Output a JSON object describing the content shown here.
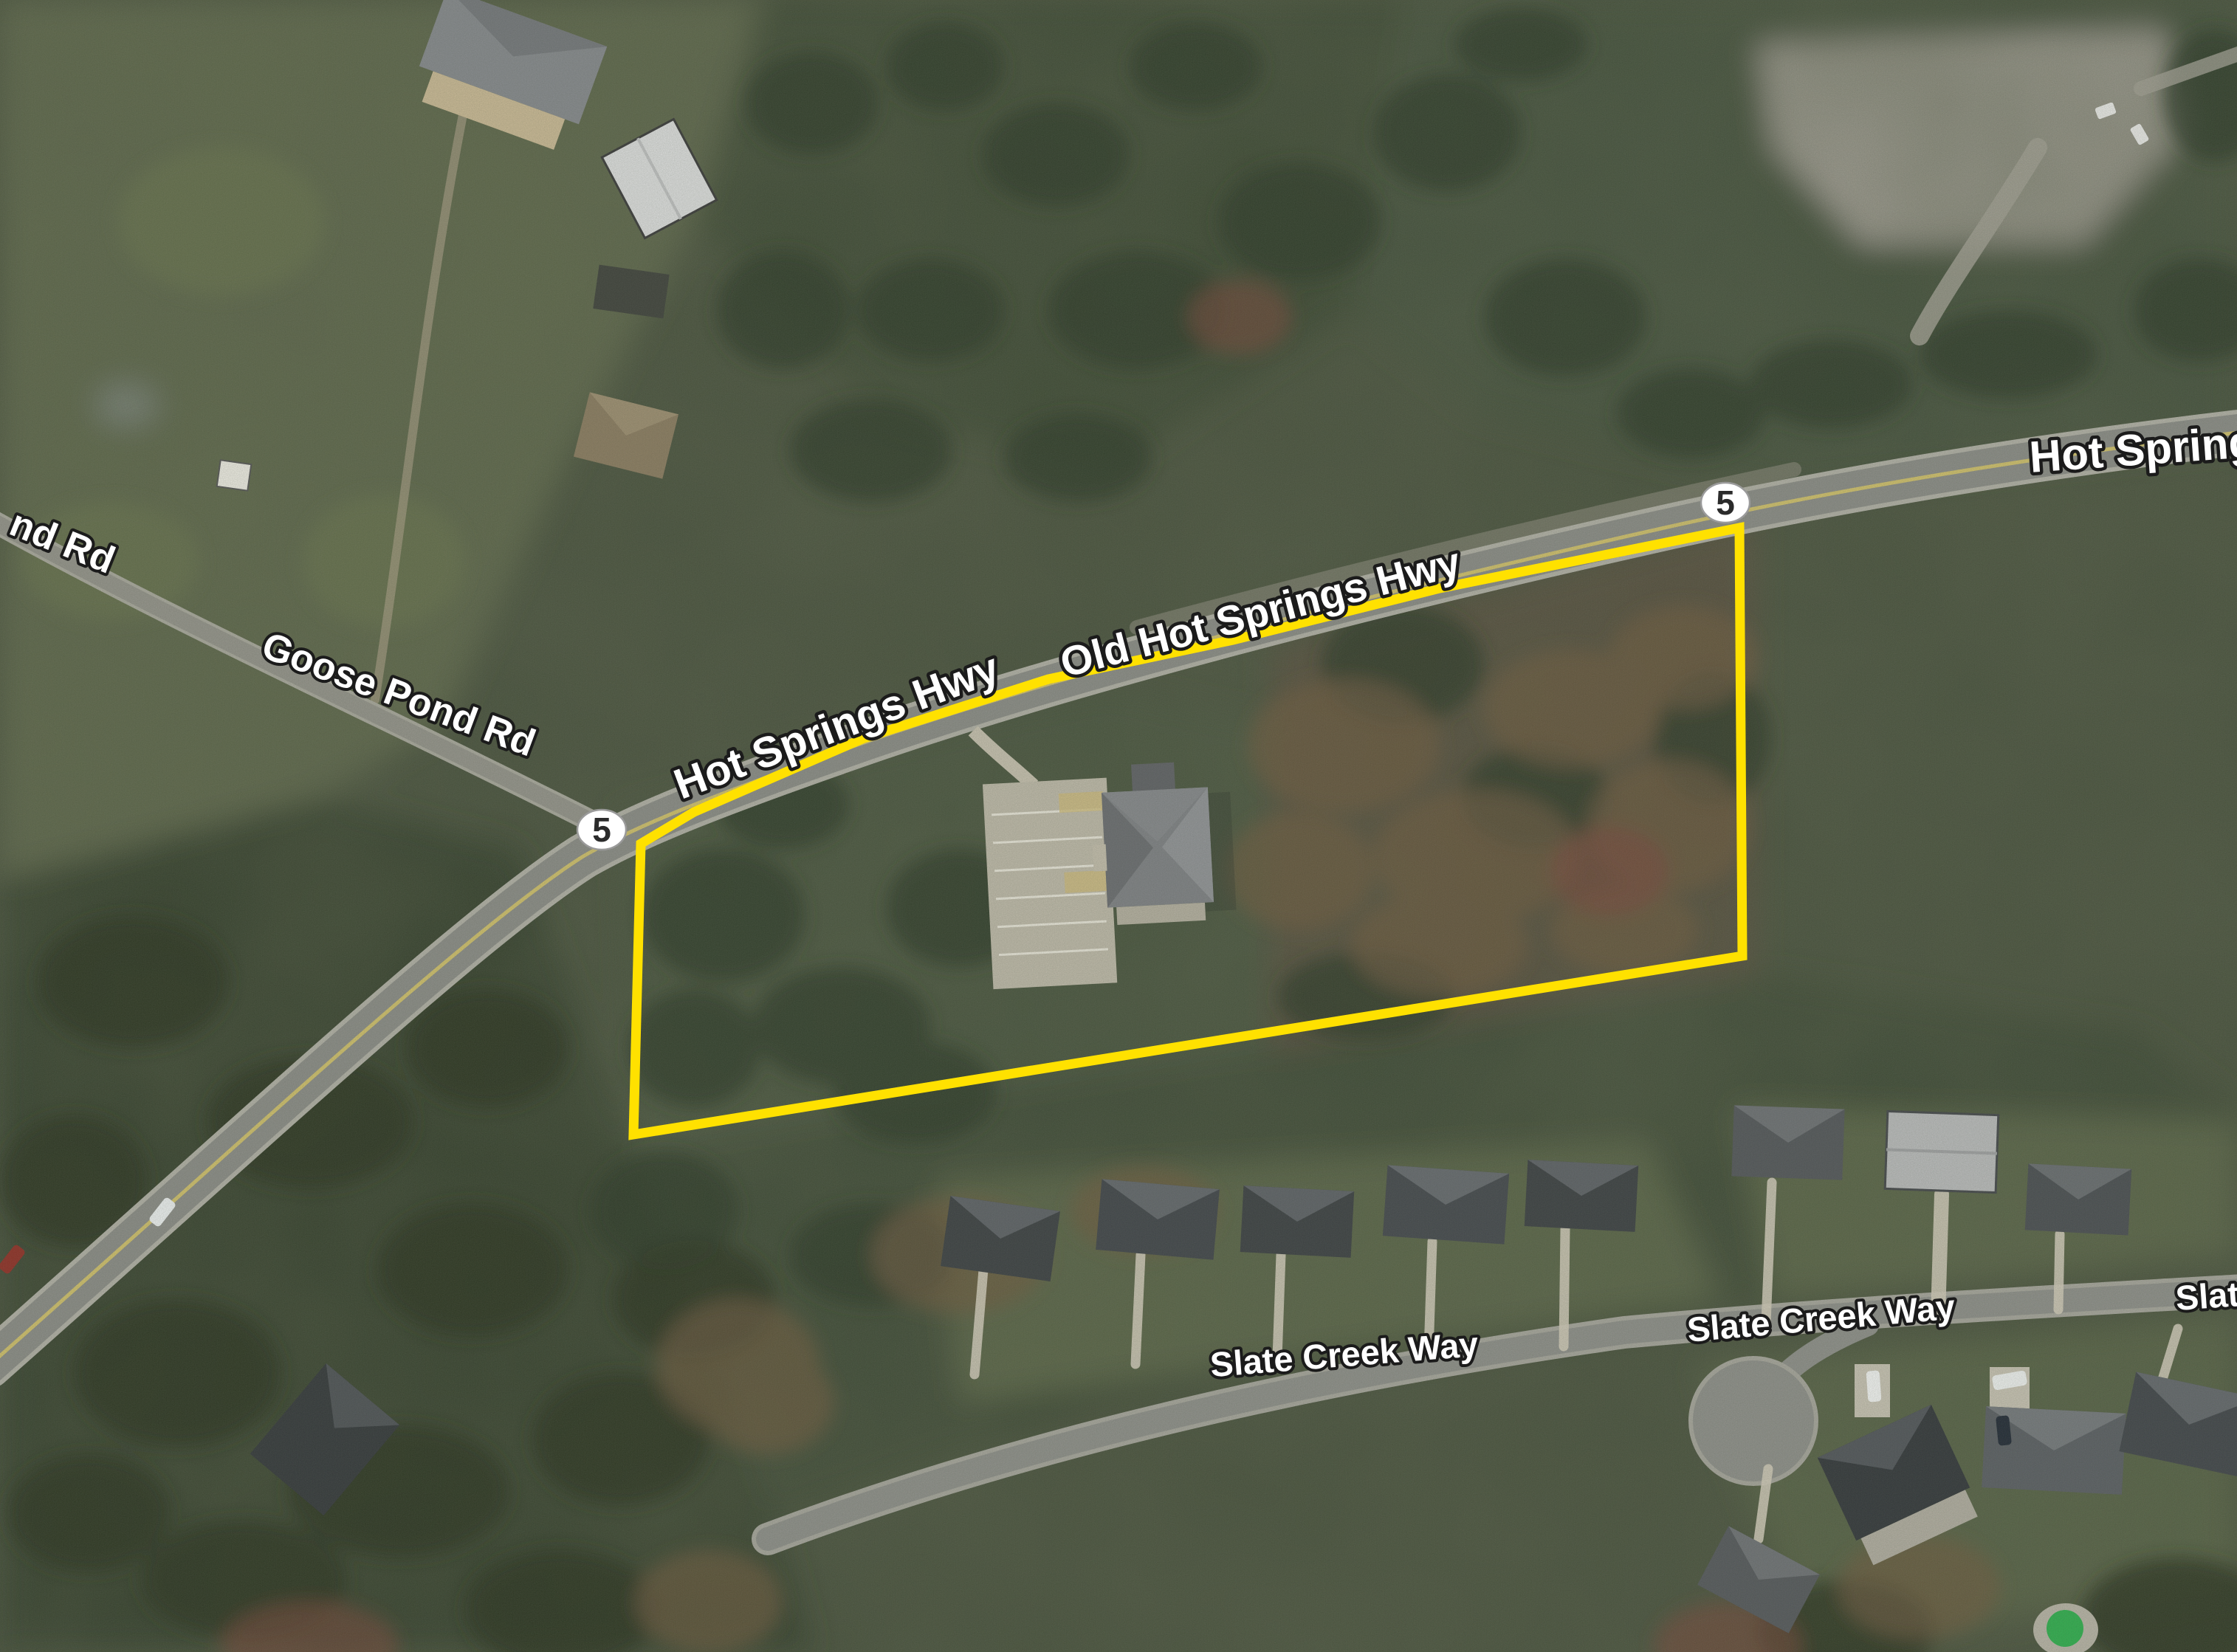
{
  "map": {
    "description": "Aerial satellite view of a wooded rural area with a property parcel outlined in yellow"
  },
  "labels": {
    "highway_right": "Hot Springs",
    "old_highway": "Old Hot Springs Hwy",
    "highway": "Hot Springs Hwy",
    "goose_pond_road": "Goose Pond Rd",
    "pond_road_partial": "nd Rd",
    "slate_creek_way_west": "Slate Creek Way",
    "slate_creek_way_east": "Slate Creek Way",
    "slate_creek_way_partial": "Slat"
  },
  "shields": {
    "route_number": "5"
  },
  "parcel": {
    "outline_color": "#FFE100"
  },
  "colors": {
    "pool_green": "#2fae4e",
    "road_gray": "#8c8d88",
    "forest_green": "#3b4632",
    "rust_brown": "#6f5a40",
    "label_text": "#ffffff",
    "label_outline": "#1b1b1b"
  }
}
